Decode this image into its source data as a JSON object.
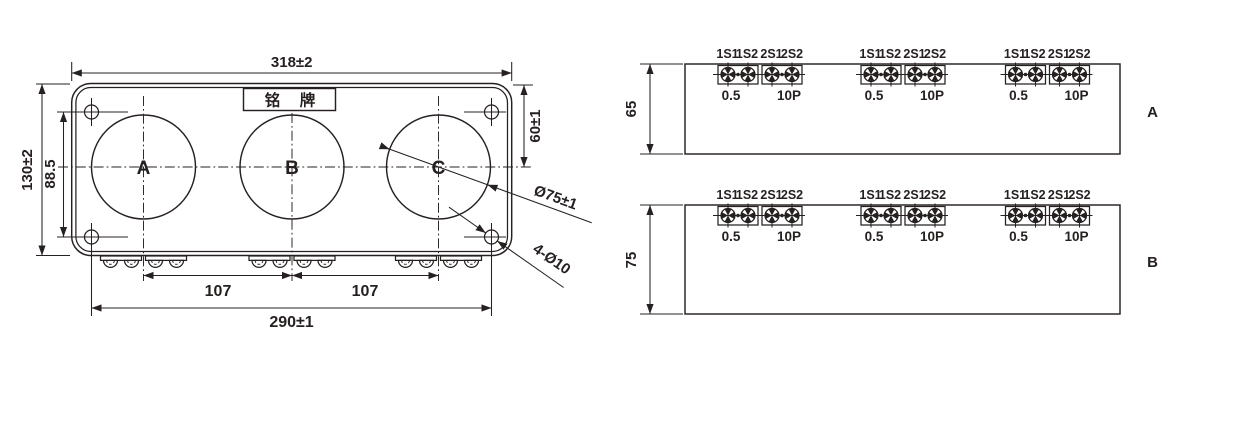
{
  "colors": {
    "line": "#262120",
    "background": "#ffffff"
  },
  "front_view": {
    "nameplate_label": "铭　牌",
    "phase_labels": {
      "a": "A",
      "b": "B",
      "c": "C"
    },
    "dims": {
      "overall_width": "318±2",
      "overall_height": "130±2",
      "mount_hole_vertical_spacing": "88.5",
      "top_to_centerline": "60±1",
      "primary_hole_diameter": "Ø75±1",
      "mount_holes": "4-Ø10",
      "pitch_ab": "107",
      "pitch_bc": "107",
      "mount_hole_horizontal_spacing": "290±1"
    }
  },
  "side_views": {
    "a": {
      "label": "A",
      "depth": "65"
    },
    "b": {
      "label": "B",
      "depth": "75"
    }
  },
  "terminals": {
    "t1": "1S1",
    "t2": "1S2",
    "t3": "2S1",
    "t4": "2S2",
    "class1": "0.5",
    "class2": "10P"
  }
}
